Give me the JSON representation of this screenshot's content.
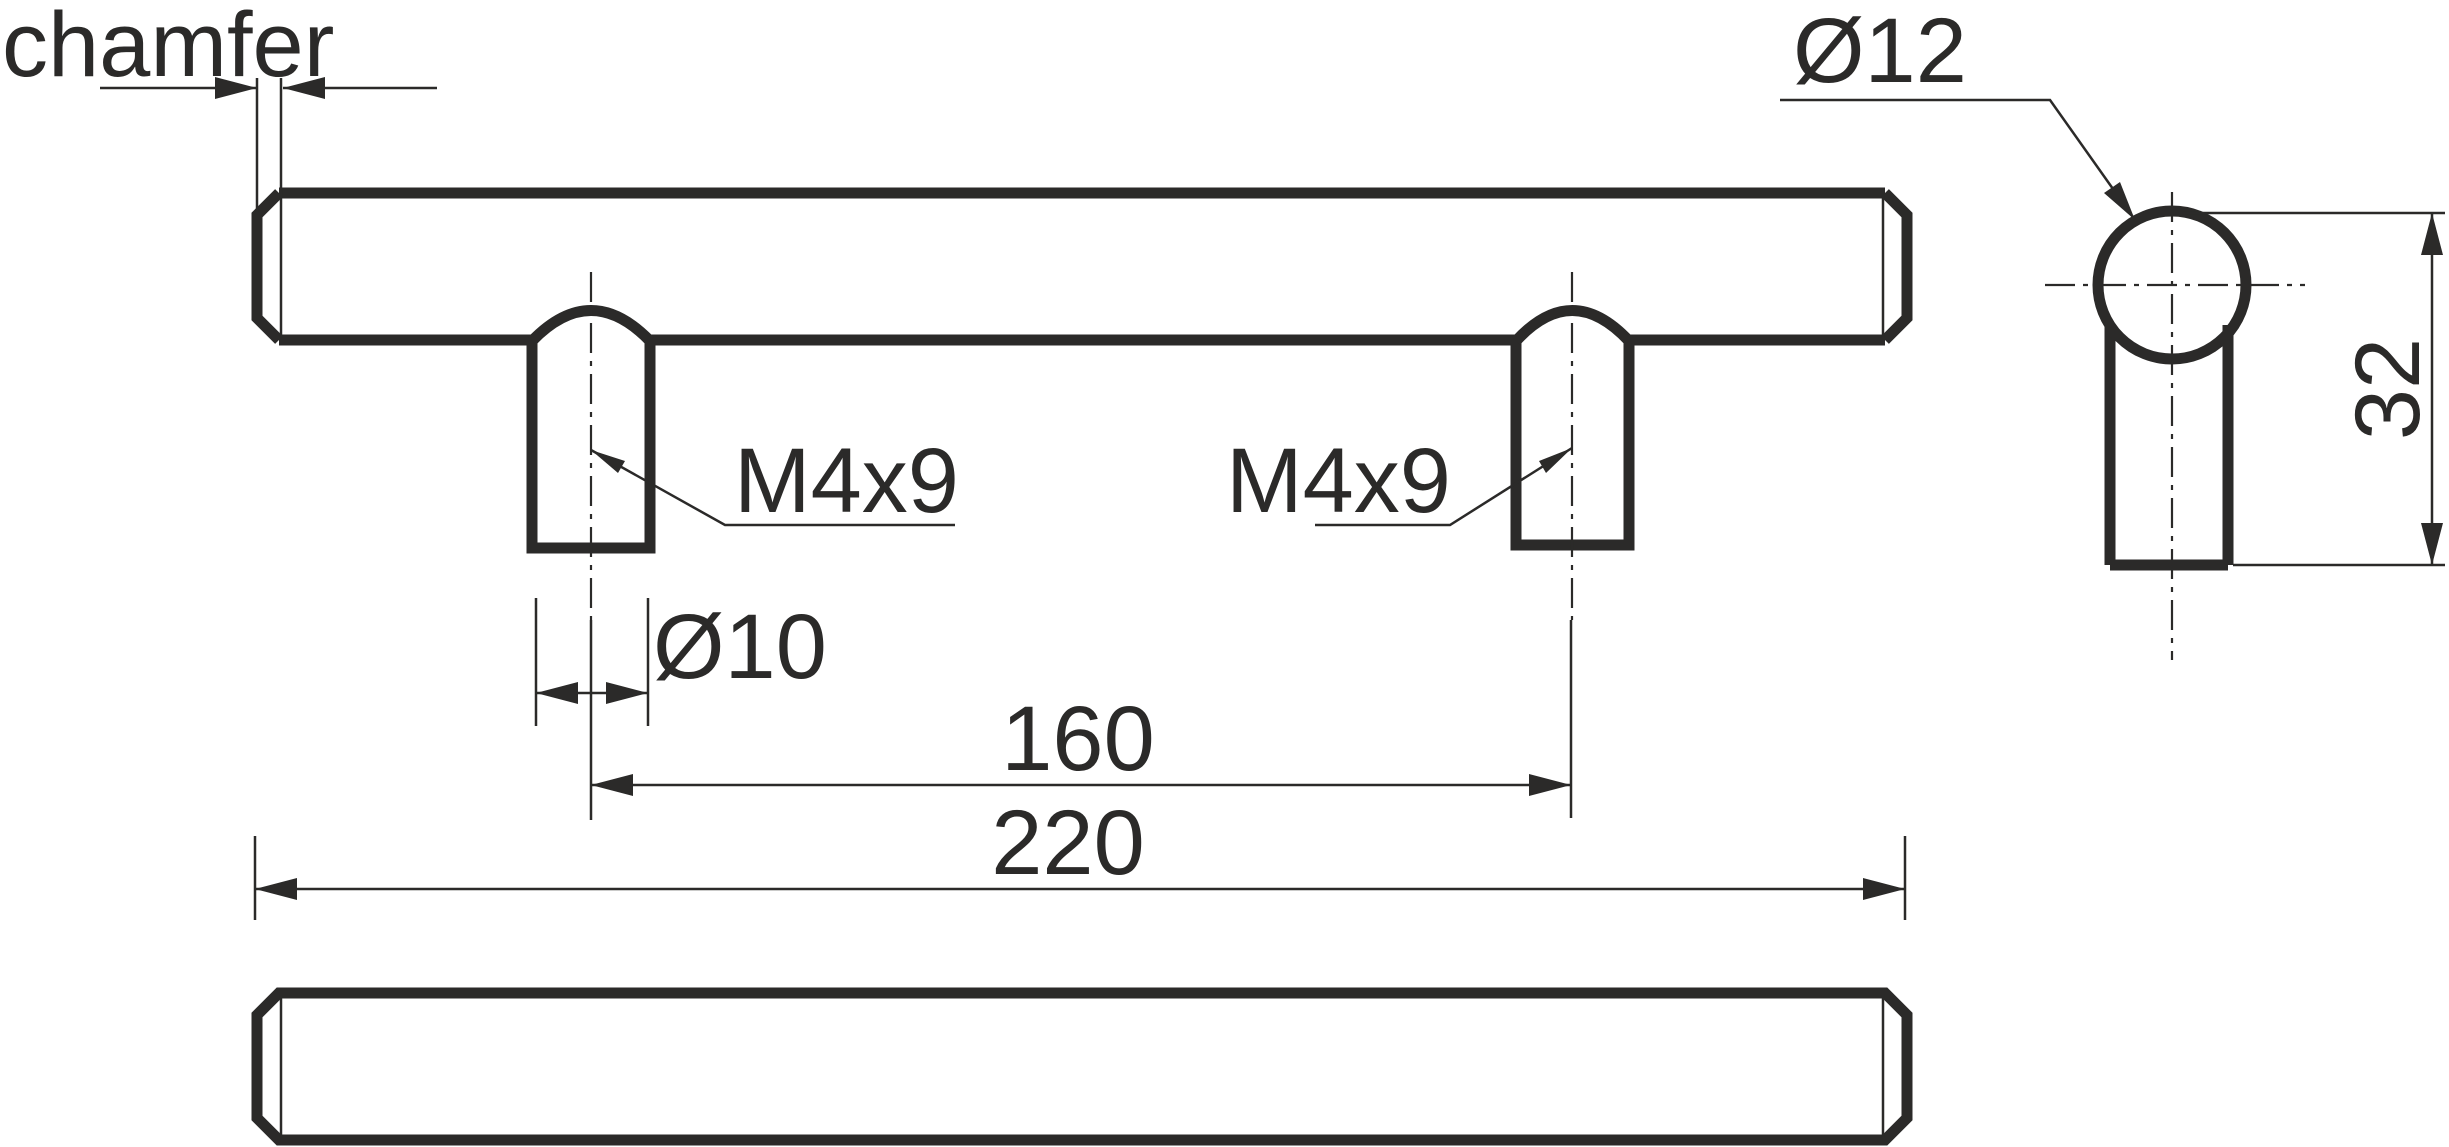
{
  "drawing": {
    "labels": {
      "chamfer": "chamfer",
      "bar_diameter": "Ø12",
      "thread_left": "M4x9",
      "thread_right": "M4x9",
      "post_diameter": "Ø10",
      "hole_spacing": "160",
      "overall_length": "220",
      "overall_height": "32"
    },
    "colors": {
      "ink": "#2b2a29",
      "background": "#ffffff"
    }
  }
}
